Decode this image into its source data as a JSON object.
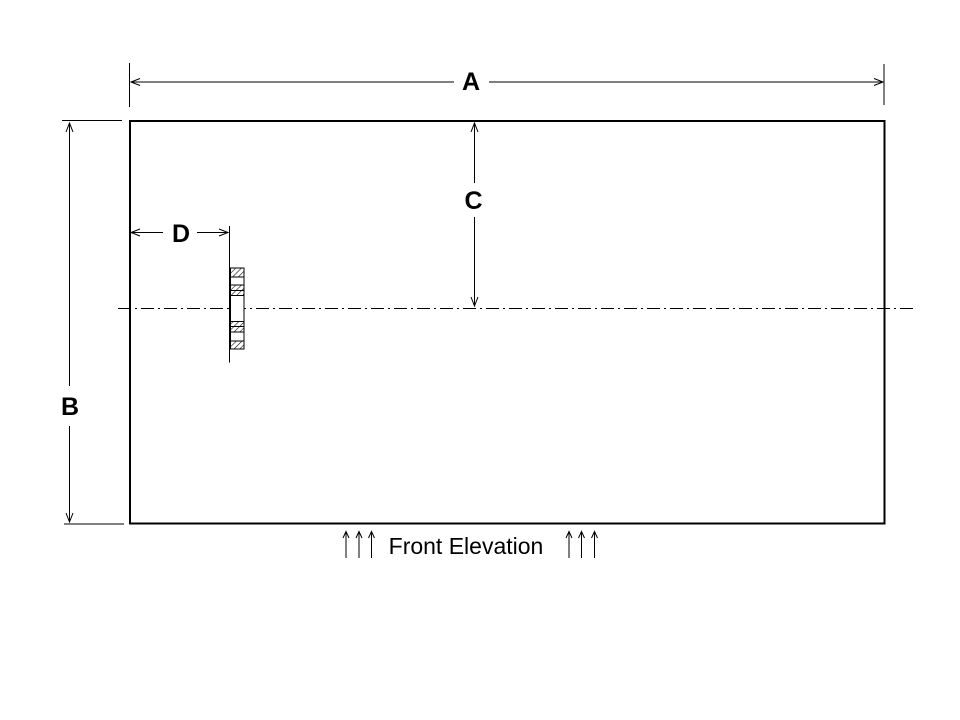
{
  "drawing": {
    "title": "Front Elevation",
    "dimension_labels": {
      "a": "A",
      "b": "B",
      "c": "C",
      "d": "D"
    },
    "colors": {
      "line": "#000000",
      "background": "#ffffff"
    }
  }
}
